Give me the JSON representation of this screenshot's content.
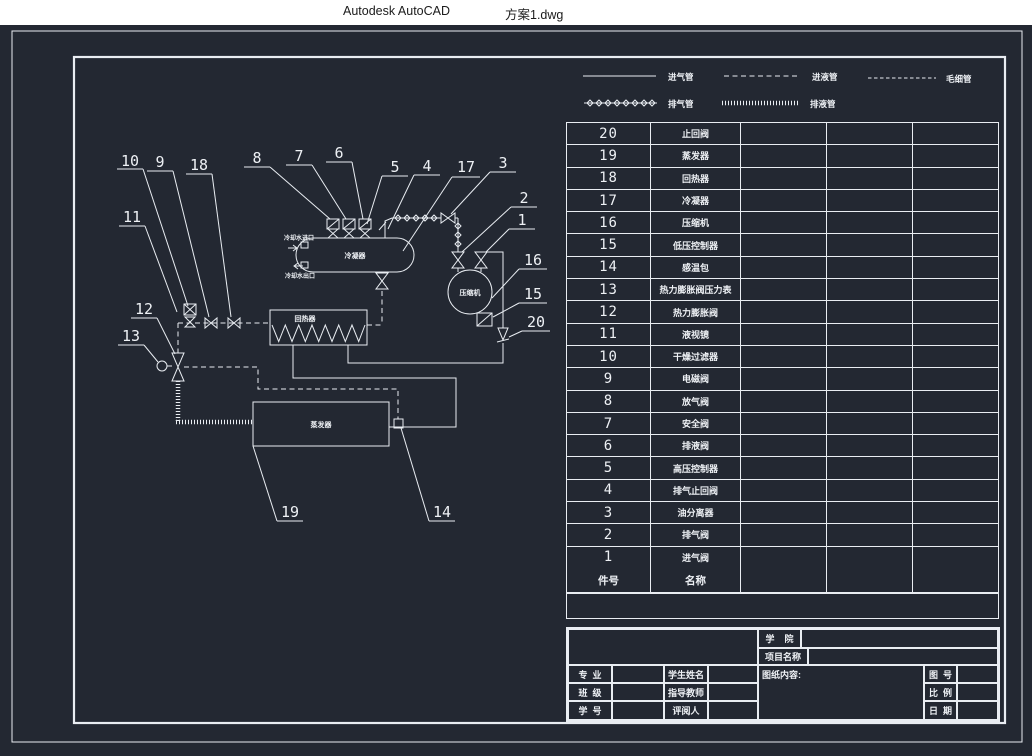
{
  "window": {
    "app_title": "Autodesk AutoCAD",
    "doc_title": "方案1.dwg"
  },
  "colors": {
    "canvas_bg": "#232832",
    "line": "#e9edf2",
    "titlebar_bg": "#ffffff"
  },
  "legend": {
    "items": [
      {
        "label": "进气管",
        "style": "solid"
      },
      {
        "label": "进液管",
        "style": "dashed"
      },
      {
        "label": "毛细管",
        "style": "fine-dashed"
      },
      {
        "label": "排气管",
        "style": "diamond-marked"
      },
      {
        "label": "排液管",
        "style": "hatched"
      }
    ]
  },
  "diagram": {
    "labels": {
      "condenser": "冷凝器",
      "compressor": "压缩机",
      "regenerator": "回热器",
      "evaporator": "蒸发器",
      "cooling_water_inlet": "冷却水进口",
      "cooling_water_outlet": "冷却水出口"
    },
    "callouts": {
      "c1": "1",
      "c2": "2",
      "c3": "3",
      "c4": "4",
      "c5": "5",
      "c6": "6",
      "c7": "7",
      "c8": "8",
      "c9": "9",
      "c10": "10",
      "c11": "11",
      "c12": "12",
      "c13": "13",
      "c14": "14",
      "c15": "15",
      "c16": "16",
      "c17": "17",
      "c18": "18",
      "c19": "19",
      "c20": "20"
    }
  },
  "parts_table": {
    "header": {
      "no": "件号",
      "name": "名称"
    },
    "rows": [
      {
        "no": "20",
        "name": "止回阀"
      },
      {
        "no": "19",
        "name": "蒸发器"
      },
      {
        "no": "18",
        "name": "回热器"
      },
      {
        "no": "17",
        "name": "冷凝器"
      },
      {
        "no": "16",
        "name": "压缩机"
      },
      {
        "no": "15",
        "name": "低压控制器"
      },
      {
        "no": "14",
        "name": "感温包"
      },
      {
        "no": "13",
        "name": "热力膨胀阀压力表"
      },
      {
        "no": "12",
        "name": "热力膨胀阀"
      },
      {
        "no": "11",
        "name": "液视镜"
      },
      {
        "no": "10",
        "name": "干燥过滤器"
      },
      {
        "no": "9",
        "name": "电磁阀"
      },
      {
        "no": "8",
        "name": "放气阀"
      },
      {
        "no": "7",
        "name": "安全阀"
      },
      {
        "no": "6",
        "name": "排液阀"
      },
      {
        "no": "5",
        "name": "高压控制器"
      },
      {
        "no": "4",
        "name": "排气止回阀"
      },
      {
        "no": "3",
        "name": "油分离器"
      },
      {
        "no": "2",
        "name": "排气阀"
      },
      {
        "no": "1",
        "name": "进气阀"
      }
    ]
  },
  "title_block": {
    "college_label": "学    院",
    "project_label": "项目名称",
    "content_label": "图纸内容:",
    "major_label": "专  业",
    "class_label": "班  级",
    "student_no_label": "学  号",
    "student_name_label": "学生姓名",
    "advisor_label": "指导教师",
    "reviewer_label": "评阅人",
    "drawing_no_label": "图  号",
    "scale_label": "比  例",
    "date_label": "日  期"
  }
}
